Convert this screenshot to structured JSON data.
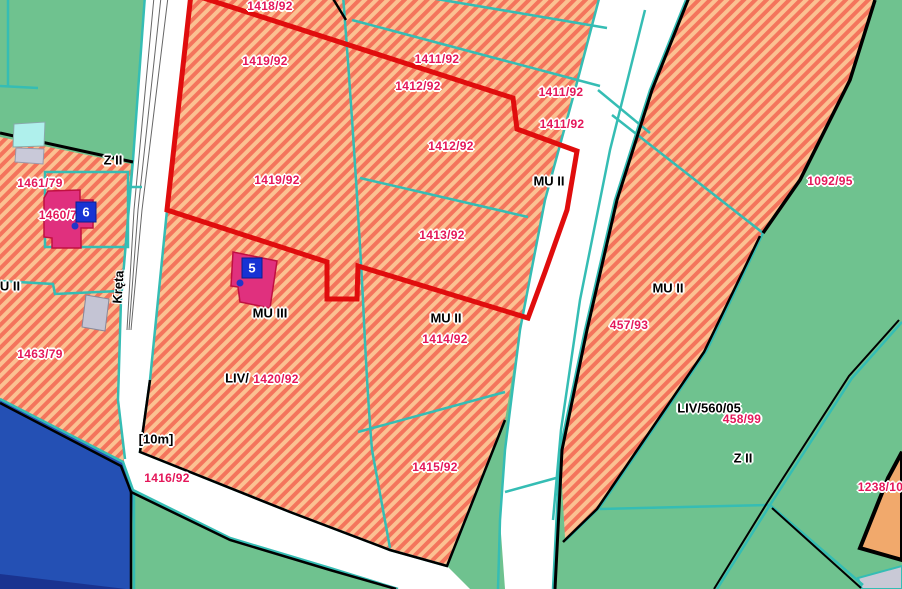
{
  "map": {
    "colors": {
      "selection_outline": "#e00d0d",
      "parcel_number_text": "#e4175a",
      "zone_text": "#000000",
      "cadastral_line": "#35bdb4",
      "residential_hatch_base": "#f4745c",
      "residential_hatch_stripe": "#fbc192",
      "green_zone": "#6fc28f",
      "water_zone": "#2450b4",
      "road": "#ffffff",
      "building": "#e0307e",
      "marker": "#1733d4",
      "tan_parcel": "#f1a96c"
    },
    "street": {
      "name": "Kręta"
    },
    "road_width_note": "[10m]"
  },
  "parcel_labels": [
    {
      "text": "1418/92"
    },
    {
      "text": "1419/92"
    },
    {
      "text": "1411/92"
    },
    {
      "text": "1412/92"
    },
    {
      "text": "1411/92"
    },
    {
      "text": "1411/92"
    },
    {
      "text": "1412/92"
    },
    {
      "text": "1419/92"
    },
    {
      "text": "1092/95"
    },
    {
      "text": "1461/79"
    },
    {
      "text": "1460/7"
    },
    {
      "text": "1413/92"
    },
    {
      "text": "457/93"
    },
    {
      "text": "1414/92"
    },
    {
      "text": "1463/79"
    },
    {
      "text": "1420/92"
    },
    {
      "text": "1416/92"
    },
    {
      "text": "1415/92"
    },
    {
      "text": "458/99"
    },
    {
      "text": "1238/100"
    }
  ],
  "zone_labels": [
    {
      "text": "Z II"
    },
    {
      "text": "MU II"
    },
    {
      "text": "MU II"
    },
    {
      "text": "MU III"
    },
    {
      "text": "MU II"
    },
    {
      "text": "LIV/"
    },
    {
      "text": "LIV/560/05"
    },
    {
      "text": "Z II"
    },
    {
      "text": "U II"
    }
  ],
  "markers": [
    {
      "number": "5"
    },
    {
      "number": "6"
    }
  ]
}
